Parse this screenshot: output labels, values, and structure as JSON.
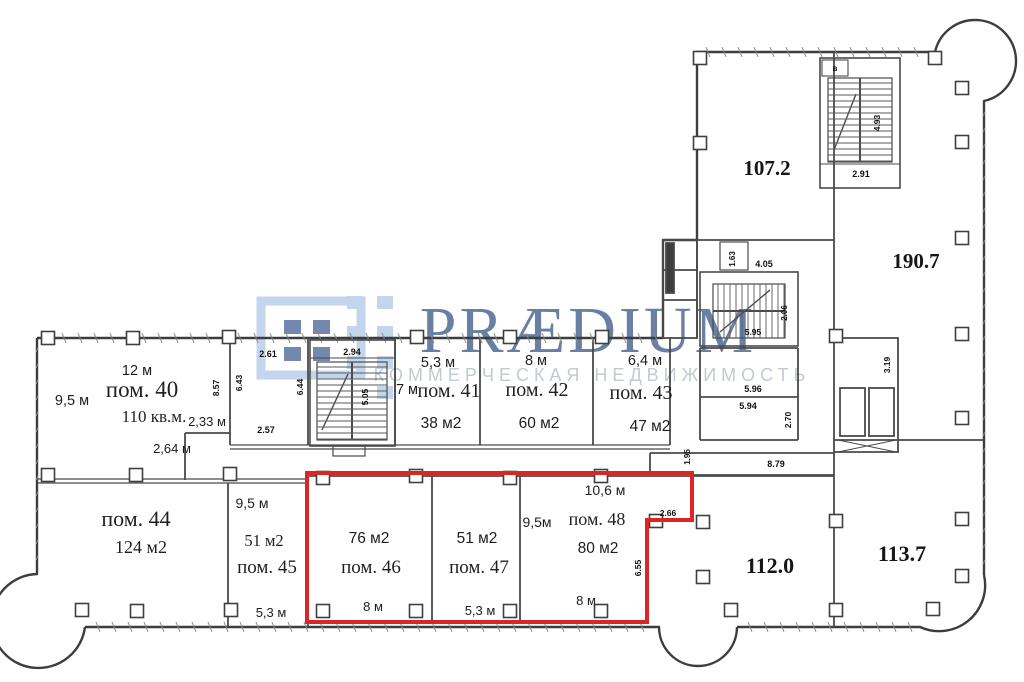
{
  "watermark": {
    "brand": "PRÆDIUM",
    "subtitle": "КОММЕРЧЕСКАЯ НЕДВИЖИМОСТЬ"
  },
  "colors": {
    "highlight_red": "#dd2426",
    "wall_gray": "#4a4a4a",
    "brand_navy": "#2c4a7e",
    "logo_light_blue": "#b9cde8",
    "subtitle_gray": "#bcc5ce"
  },
  "zones": {
    "z107": {
      "label": "107.2"
    },
    "z190": {
      "label": "190.7"
    },
    "z112": {
      "label": "112.0"
    },
    "z113": {
      "label": "113.7"
    }
  },
  "rooms": {
    "pom40": {
      "name": "пом. 40",
      "area": "110 кв.м.",
      "top": "12 м",
      "left": "9,5 м"
    },
    "pom41": {
      "name": "пом. 41",
      "area": "38 м2",
      "top": "5,3 м",
      "left": "7 м"
    },
    "pom42": {
      "name": "пом. 42",
      "area": "60 м2",
      "top": "8 м"
    },
    "pom43": {
      "name": "пом. 43",
      "area": "47 м2",
      "top": "6,4 м"
    },
    "pom44": {
      "name": "пом. 44",
      "area": "124 м2"
    },
    "pom45": {
      "name": "пом. 45",
      "area": "51 м2",
      "top": "9,5 м",
      "bottom": "5,3 м"
    },
    "pom46": {
      "name": "пом. 46",
      "area": "76 м2",
      "bottom": "8 м"
    },
    "pom47": {
      "name": "пом. 47",
      "area": "51 м2",
      "bottom": "5,3 м"
    },
    "pom48": {
      "name": "пом. 48",
      "area": "80 м2",
      "top": "10,6 м",
      "left": "9,5м",
      "bottom": "8 м"
    }
  },
  "dims": {
    "d233": "2,33 м",
    "d264": "2,64 м",
    "d857": "8.57",
    "d261": "2.61",
    "d643": "6.43",
    "d644": "6.44",
    "d257": "2.57",
    "d294": "2.94",
    "d505": "5.05",
    "d291": "2.91",
    "d493": "4.93",
    "stair_room": "в",
    "d163": "1.63",
    "d405": "4.05",
    "d206": "2.06",
    "d595": "5.95",
    "d596": "5.96",
    "d594": "5.94",
    "d270": "2.70",
    "d195": "1.95",
    "d879": "8.79",
    "d319": "3.19",
    "d266": "2.66",
    "d655": "6.55"
  }
}
